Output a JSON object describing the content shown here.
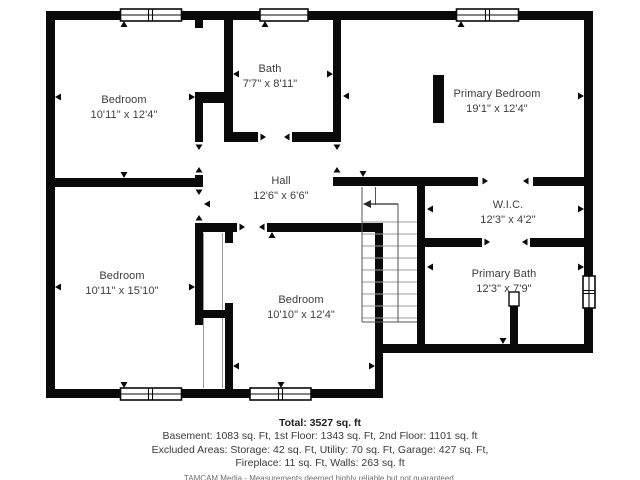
{
  "plan": {
    "rooms": [
      {
        "name": "Bedroom",
        "dims": "10'11\" x 12'4\""
      },
      {
        "name": "Bath",
        "dims": "7'7\" x 8'11\""
      },
      {
        "name": "Primary Bedroom",
        "dims": "19'1\" x 12'4\""
      },
      {
        "name": "Hall",
        "dims": "12'6\" x 6'6\""
      },
      {
        "name": "W.I.C.",
        "dims": "12'3\" x 4'2\""
      },
      {
        "name": "Primary Bath",
        "dims": "12'3\" x 7'9\""
      },
      {
        "name": "Bedroom",
        "dims": "10'11\" x 15'10\""
      },
      {
        "name": "Bedroom",
        "dims": "10'10\" x 12'4\""
      }
    ]
  },
  "footer": {
    "total": "Total: 3527 sq. ft",
    "line1": "Basement: 1083 sq. Ft, 1st Floor: 1343 sq. Ft, 2nd Floor: 1101 sq. ft",
    "line2": "Excluded Areas: Storage: 42 sq. Ft, Utility: 70 sq. Ft, Garage: 427 sq. Ft,",
    "line3": "Fireplace: 11 sq. Ft, Walls: 263 sq. ft",
    "branding": "TAMCAM Media - Measurements deemed highly reliable but not guaranteed."
  },
  "colors": {
    "wall": "#0a0a0a",
    "text": "#3d3d3d",
    "stair_thin": "#999999",
    "stair_edge": "#555555"
  }
}
